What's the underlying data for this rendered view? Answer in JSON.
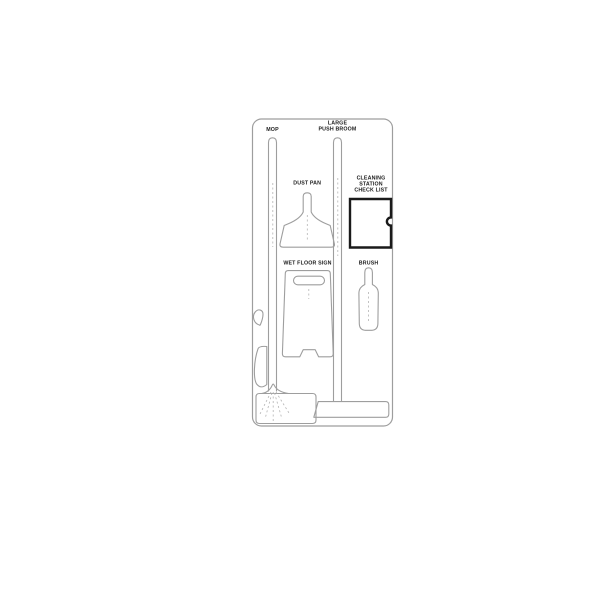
{
  "board": {
    "type": "cleaning-station-shadow-board-line-drawing",
    "labels": {
      "mop": "MOP",
      "large_push_broom": [
        "LARGE",
        "PUSH BROOM"
      ],
      "dust_pan": "DUST PAN",
      "cleaning_station_check_list": [
        "CLEANING",
        "STATION",
        "CHECK LIST"
      ],
      "wet_floor_sign": "WET FLOOR SIGN",
      "brush": "BRUSH"
    },
    "colors": {
      "outline": "#9e9e9e",
      "checklist_border": "#1a1a1a",
      "label_text": "#1c1c1c",
      "background": "#ffffff"
    }
  }
}
